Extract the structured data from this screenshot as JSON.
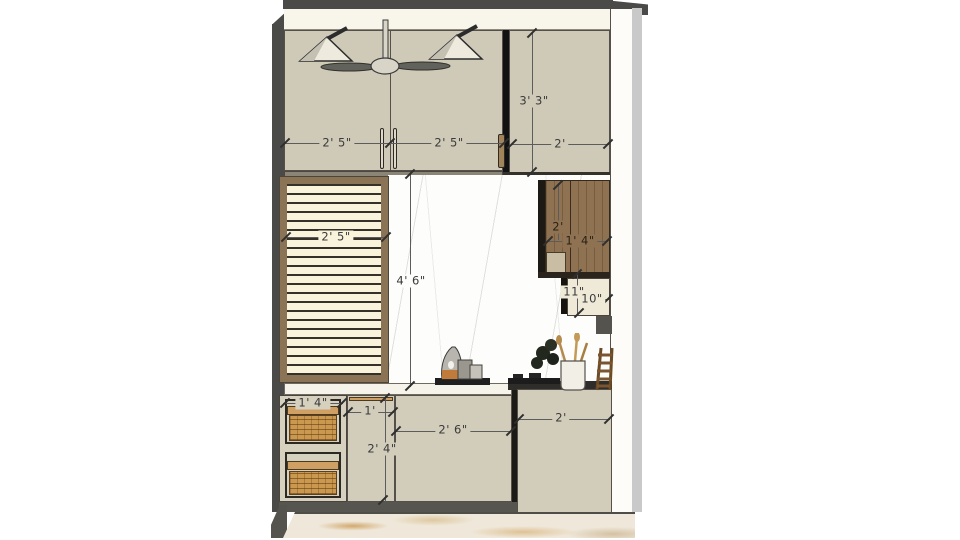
{
  "scene": {
    "description": "Kitchen elevation 3D render with dimension annotations",
    "objects": [
      "ceiling-fan",
      "pendant-light-left",
      "pendant-light-right",
      "upper-cabinets",
      "tall-cabinet",
      "louver-window",
      "marble-backsplash",
      "wood-wall-cabinet",
      "open-shelf",
      "basket-unit",
      "base-cabinets",
      "stove",
      "utensil-holder",
      "jug",
      "plant",
      "ladder-rack",
      "marble-floor"
    ]
  },
  "dimensions": {
    "upper_left_door": "2' 5\"",
    "upper_right_door": "2' 5\"",
    "tall_cabinet_width": "2'",
    "tall_cabinet_height": "3' 3\"",
    "window_width": "2' 5\"",
    "backsplash_height": "4' 6\"",
    "wood_cabinet_height": "2'",
    "wood_cabinet_width": "1' 4\"",
    "open_shelf_height": "11\"",
    "open_shelf_width": "10\"",
    "basket_unit_width": "1' 4\"",
    "base_narrow_door_width": "1'",
    "base_cabinet_height": "2' 4\"",
    "base_wide_door_width": "2' 6\"",
    "base_right_unit_width": "2'"
  },
  "colors": {
    "cabinet_tan": "#cfc9b7",
    "wood_brown": "#8f7252",
    "wicker": "#cb9850",
    "soffit_white": "#f8f5ea",
    "structure_dark": "#4a4a48",
    "marble_vein_gold": "#c68d40",
    "dimension_text": "#3a3a3a"
  }
}
